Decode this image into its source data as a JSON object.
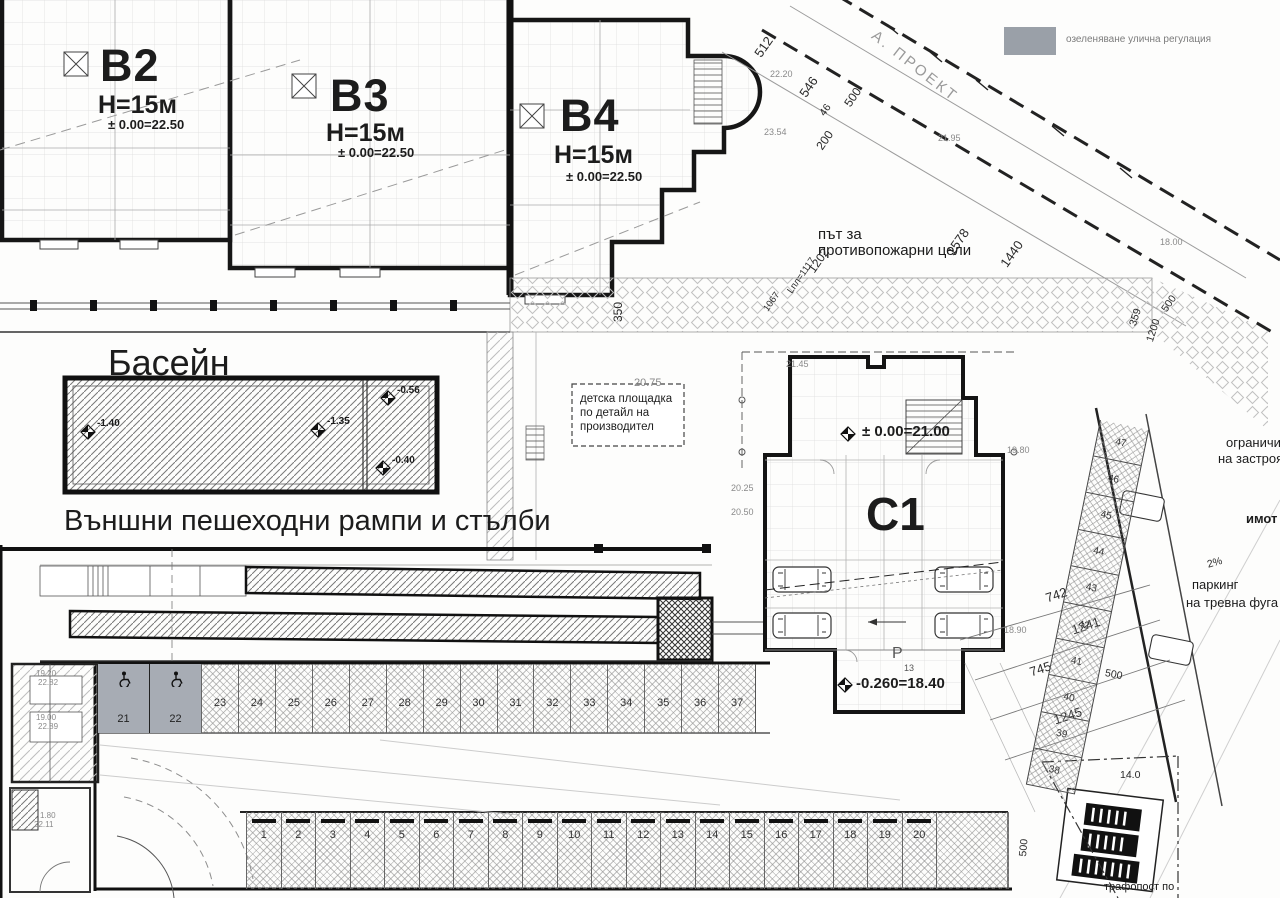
{
  "legend": {
    "swatch_color": "#9aa0a8",
    "label": "озеленяване улична регулация"
  },
  "corner_note": "А. ПРОЕКТ",
  "buildings": {
    "b2": {
      "name": "В2",
      "height": "Н=15м",
      "level": "± 0.00=22.50"
    },
    "b3": {
      "name": "В3",
      "height": "Н=15м",
      "level": "± 0.00=22.50"
    },
    "b4": {
      "name": "В4",
      "height": "Н=15м",
      "level": "± 0.00=22.50"
    },
    "c1": {
      "name": "С1",
      "level": "± 0.00=21.00",
      "parking_letter": "Р",
      "parking_count": "13",
      "parking_level": "-0.260=18.40"
    }
  },
  "pool": {
    "label": "Басейн",
    "marks": [
      "-1.40",
      "-1.35",
      "-0.56",
      "-0.40"
    ]
  },
  "captions": {
    "ramps": "Външни пешеходни рампи и стълби",
    "fire_road_line1": "път за",
    "fire_road_line2": "противопожарни цели",
    "playground_line1": "детска площадка",
    "playground_line2": "по детайл на",
    "playground_line3": "производител",
    "limit_line1": "ограничит",
    "limit_line2": "на застрояв",
    "property": "имот",
    "grass_parking_line1": "паркинг",
    "grass_parking_line2": "на тревна фуга",
    "transformer": "трафопост по"
  },
  "dims": {
    "d512": "512",
    "d546": "546",
    "d46": "46",
    "d500_top": "500",
    "d200": "200",
    "d1578": "1578",
    "d1440": "1440",
    "d359": "359",
    "d1200": "1200",
    "d500_right": "500",
    "d350": "350",
    "d1202": "1202",
    "dLpl": "Lпл=1117",
    "d1067": "1067",
    "d742": "742",
    "d1241": "1241",
    "d745": "745",
    "d1245": "1245",
    "d500_strip": "500",
    "d14": "14.0",
    "d500_bottom": "500",
    "d2pct": "2%"
  },
  "elevations": {
    "e1": "22.20",
    "e2": "23.54",
    "e3": "21.95",
    "e4": "20.75",
    "e5": "20.25",
    "e6": "20.50",
    "e7": "21.45",
    "e8": "19.80",
    "e9": "18.90",
    "e10": "18.00",
    "e11": "19.20",
    "e12": "22.82",
    "e13": "19.00",
    "e14": "22.89",
    "e15": "1.80",
    "e16": "22.11"
  },
  "parking": {
    "accessible": [
      "21",
      "22"
    ],
    "middle": [
      "23",
      "24",
      "25",
      "26",
      "27",
      "28",
      "29",
      "30",
      "31",
      "32",
      "33",
      "34",
      "35",
      "36",
      "37"
    ],
    "bottom": [
      "1",
      "2",
      "3",
      "4",
      "5",
      "6",
      "7",
      "8",
      "9",
      "10",
      "11",
      "12",
      "13",
      "14",
      "15",
      "16",
      "17",
      "18",
      "19",
      "20"
    ],
    "strip": [
      "47",
      "46",
      "45",
      "44",
      "43",
      "42",
      "41",
      "40",
      "39",
      "38"
    ]
  }
}
